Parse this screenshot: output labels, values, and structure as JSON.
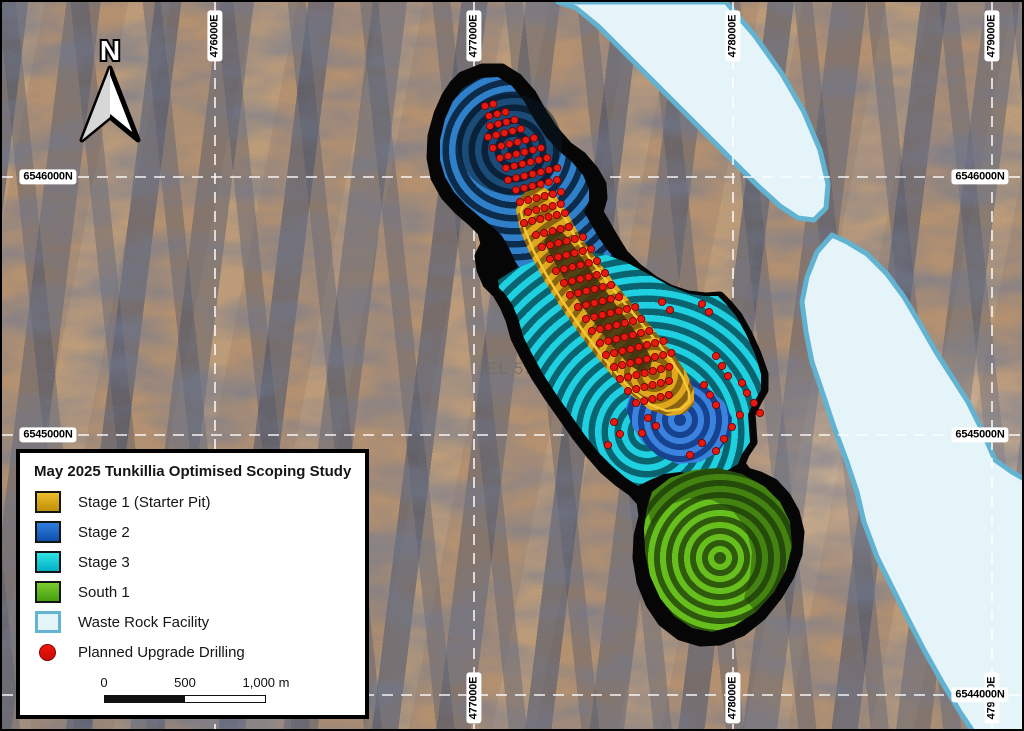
{
  "map": {
    "north_label": "N",
    "tenement_label": "EL 590",
    "grid": {
      "eastings": [
        {
          "label": "476000E",
          "x": 213,
          "top": true,
          "bottom": false
        },
        {
          "label": "477000E",
          "x": 472,
          "top": true,
          "bottom": true
        },
        {
          "label": "478000E",
          "x": 731,
          "top": true,
          "bottom": true
        },
        {
          "label": "479000E",
          "x": 990,
          "top": true,
          "bottom": true
        }
      ],
      "northings": [
        {
          "label": "6546000N",
          "y": 175,
          "left": true,
          "right": true
        },
        {
          "label": "6545000N",
          "y": 433,
          "left": true,
          "right": true
        },
        {
          "label": "6544000N",
          "y": 693,
          "left": true,
          "right": true
        }
      ]
    },
    "drill_rows": [
      [
        483,
        104,
        2
      ],
      [
        487,
        114,
        3
      ],
      [
        488,
        124,
        4
      ],
      [
        486,
        135,
        5
      ],
      [
        491,
        146,
        6
      ],
      [
        498,
        156,
        6
      ],
      [
        504,
        166,
        6
      ],
      [
        506,
        178,
        7
      ],
      [
        514,
        188,
        6
      ],
      [
        518,
        200,
        6
      ],
      [
        526,
        210,
        5
      ],
      [
        522,
        221,
        6
      ],
      [
        534,
        233,
        5
      ],
      [
        540,
        245,
        6
      ],
      [
        548,
        257,
        6
      ],
      [
        554,
        269,
        6
      ],
      [
        562,
        281,
        6
      ],
      [
        568,
        293,
        6
      ],
      [
        576,
        305,
        6
      ],
      [
        584,
        317,
        7
      ],
      [
        590,
        329,
        7
      ],
      [
        598,
        341,
        7
      ],
      [
        604,
        353,
        8
      ],
      [
        612,
        365,
        8
      ],
      [
        618,
        377,
        7
      ],
      [
        626,
        389,
        6
      ],
      [
        634,
        401,
        5
      ]
    ],
    "drill_extra": [
      [
        700,
        302
      ],
      [
        707,
        310
      ],
      [
        660,
        300
      ],
      [
        668,
        308
      ],
      [
        646,
        416
      ],
      [
        654,
        424
      ],
      [
        612,
        420
      ],
      [
        618,
        432
      ],
      [
        606,
        443
      ],
      [
        714,
        354
      ],
      [
        720,
        364
      ],
      [
        726,
        374
      ],
      [
        702,
        383
      ],
      [
        708,
        393
      ],
      [
        714,
        403
      ],
      [
        740,
        381
      ],
      [
        745,
        391
      ],
      [
        752,
        401
      ],
      [
        738,
        413
      ],
      [
        730,
        425
      ],
      [
        722,
        437
      ],
      [
        714,
        449
      ],
      [
        700,
        441
      ],
      [
        688,
        453
      ],
      [
        640,
        431
      ],
      [
        758,
        411
      ]
    ]
  },
  "legend": {
    "title": "May 2025 Tunkillia Optimised Scoping Study",
    "items": [
      {
        "label": "Stage 1 (Starter Pit)",
        "swatch": "square",
        "light": "#EDBE2A",
        "dark": "#C08E08",
        "border": "#151515"
      },
      {
        "label": "Stage 2",
        "swatch": "square",
        "light": "#2E7EDC",
        "dark": "#0E4FAE",
        "border": "#151515"
      },
      {
        "label": "Stage 3",
        "swatch": "square",
        "light": "#2FE4E2",
        "dark": "#00AFC6",
        "border": "#151515"
      },
      {
        "label": "South 1",
        "swatch": "square",
        "light": "#7ACB2D",
        "dark": "#45A00F",
        "border": "#151515"
      },
      {
        "label": "Waste Rock Facility",
        "swatch": "square",
        "light": "#E4F4F9",
        "dark": "#E4F4F9",
        "border": "#64B4D2"
      },
      {
        "label": "Planned Upgrade Drilling",
        "swatch": "circle",
        "light": "#F2170B",
        "dark": "#C80A06",
        "border": "#8A0404"
      }
    ],
    "scalebar": {
      "ticks": [
        "0",
        "500",
        "1,000 m"
      ],
      "filled": "#111111",
      "empty": "#FFFFFF"
    }
  },
  "colors": {
    "stage1_light": "#DFA81C",
    "stage1_dark": "#8A6310",
    "stage2_light": "#2F7FC9",
    "stage2_dark": "#0D2C4C",
    "stage2se_light": "#3B82DF",
    "stage2se_dark": "#16428F",
    "stage3_light": "#1ED0E0",
    "stage3_dark": "#0A6470",
    "south1_light": "#66BF1D",
    "south1_dark": "#2F5A0E",
    "gold_core": "#3A2F10",
    "gold_rim": "#F2C737",
    "pit_outline": "#060606",
    "wrf_fill": "#E4F4F9",
    "wrf_border": "#62B3D1",
    "drill_fill": "#E8190F",
    "drill_stroke": "#7A0202",
    "grid_line": "#FFFFFF",
    "tenement_text": "#6F6F6F"
  }
}
